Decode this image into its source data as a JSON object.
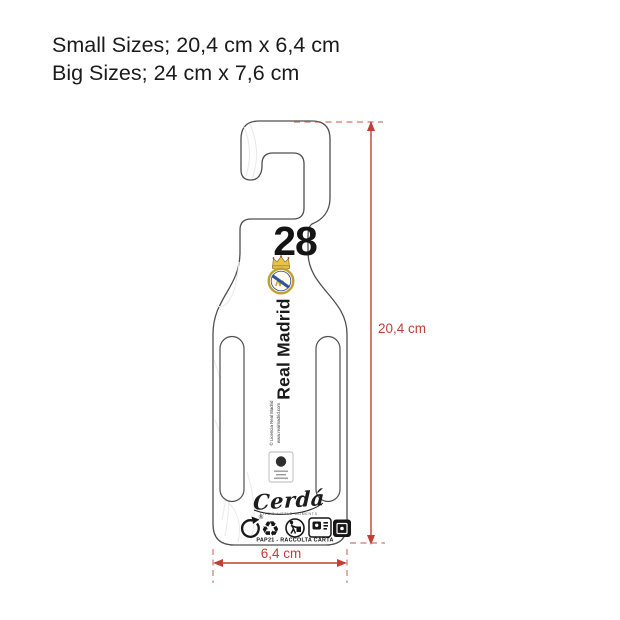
{
  "header": {
    "line1": "Small Sizes; 20,4 cm x 6,4 cm",
    "line2": "Big Sizes; 24 cm x 7,6 cm"
  },
  "hanger": {
    "size_number": "28",
    "team_name": "Real Madrid",
    "license_line1": "© Licencia Real Madrid",
    "license_line2": "www.realmadrid.com",
    "brand_script": "Cerdá",
    "brand_tagline": "LIFE'S LITTLE MOMENTS",
    "recycling_label": "PAP21 - RACCOLTA CARTA",
    "registered_mark": "®",
    "mobius_glyph": "♻"
  },
  "dimensions": {
    "height_label": "20,4 cm",
    "width_label": "6,4 cm",
    "accent_color": "#bf4037"
  }
}
